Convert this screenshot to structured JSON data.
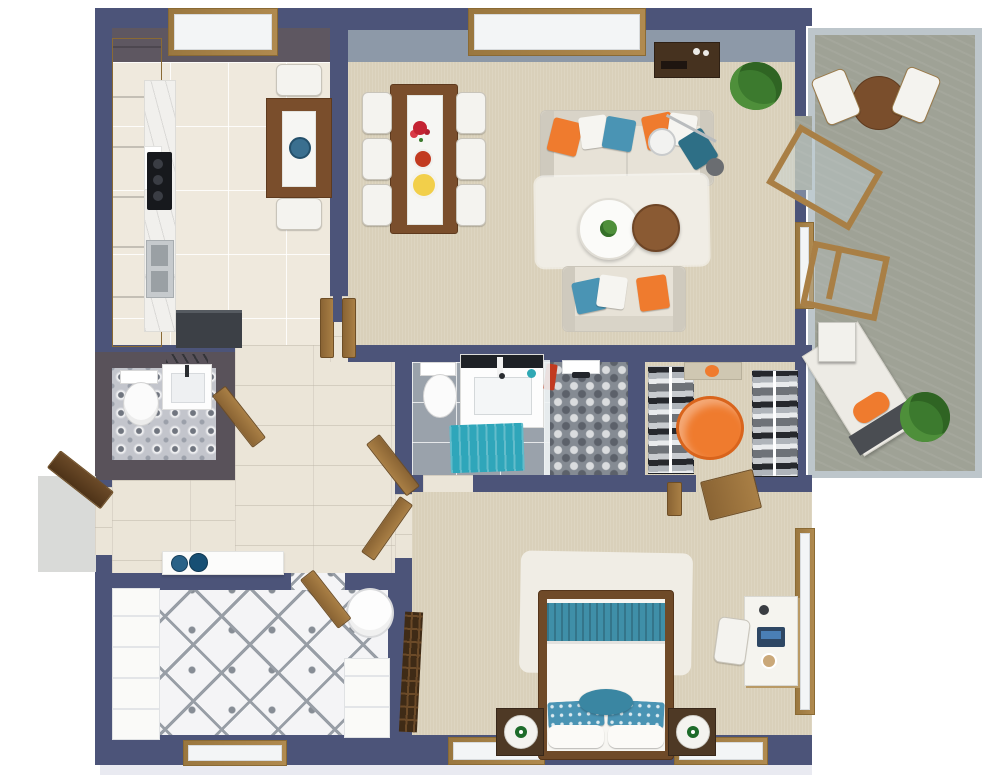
{
  "scene": {
    "type": "3d-floor-plan-render",
    "view": "top-down",
    "visible_text": "none"
  },
  "colors": {
    "wall_navy": "#4c5479",
    "wall_face_dark": "#5e5761",
    "wall_face_blue": "#8d99a8",
    "glass_rail": "#bdc6cb",
    "floor_kitchen": "#efe9dd",
    "floor_carpet": "#d9d0ba",
    "floor_hall": "#ebe5d8",
    "floor_bath": "#9aa2ab",
    "floor_shower": "#858b93",
    "floor_balcony": "#9fa296",
    "floor_wc": "#c3c5cc",
    "floor_laundry": "#f4f4f6",
    "wood": "#b08a4f",
    "wood_dark": "#7a4e2c",
    "wood_door": "#a97f45",
    "dark_console": "#46321f",
    "white_soft": "#fafaf8",
    "sofa": "#e7e2d7",
    "sofa_edge": "#cbc6ba",
    "orange": "#ef7b2e",
    "teal": "#3f8fa8",
    "teal_dark": "#2e6f86",
    "teal_mat": "#2fa6ba",
    "pillow_blue": "#4a94b4",
    "rug_white": "#f0ede5",
    "green": "#4e8f3a",
    "green_dark": "#3c7a2e",
    "steel": "#c6cacd",
    "appliance_dark": "#3c4046",
    "cooktop_black": "#17191d",
    "lamp_green": "#1d6b2a",
    "towel_red": "#c23a20",
    "plate_yellow": "#f2cf4a",
    "bowl_blue": "#2a6287",
    "shadow": "#e9eaf1"
  },
  "rooms": [
    {
      "name": "kitchen",
      "floor": "light-tile",
      "furniture": [
        "l-shaped-wood-cabinets",
        "marble-counter",
        "cooktop",
        "double-sink",
        "refrigerator",
        "breakfast-table",
        "two-white-chairs",
        "blue-plant-pot",
        "window"
      ]
    },
    {
      "name": "dining-area",
      "floor": "beige-carpet",
      "furniture": [
        "wood-dining-table",
        "white-runner",
        "red-flowers",
        "fruit-bowl",
        "yellow-plate",
        "six-white-chairs"
      ]
    },
    {
      "name": "living-room",
      "floor": "beige-carpet",
      "furniture": [
        "three-seat-sofa",
        "loveseat",
        "orange-blue-white-pillows",
        "arc-floor-lamp",
        "round-coffee-table",
        "round-wood-side-table",
        "white-area-rug",
        "media-console",
        "potted-plant",
        "open-double-doors",
        "large-window"
      ]
    },
    {
      "name": "balcony",
      "floor": "concrete",
      "furniture": [
        "glass-railing",
        "round-bistro-table",
        "two-folding-chairs",
        "wood-deck-chair",
        "open-glass-door",
        "sun-lounger",
        "orange-cushion",
        "white-side-table",
        "potted-plant"
      ]
    },
    {
      "name": "powder-room",
      "floor": "patterned-tile",
      "furniture": [
        "toilet",
        "vanity-sink",
        "mirror",
        "open-door"
      ]
    },
    {
      "name": "bathroom",
      "floor": "grey-tile",
      "furniture": [
        "toilet",
        "vanity-with-dark-top",
        "teal-bath-mat",
        "red-towel",
        "walk-in-shower",
        "hex-mosaic-floor",
        "glass-partition",
        "shower-head",
        "open-door"
      ]
    },
    {
      "name": "walk-in-closet",
      "floor": "beige-carpet",
      "furniture": [
        "clothes-rack-left",
        "clothes-rack-right",
        "orange-ottoman",
        "wall-mirror",
        "open-door"
      ]
    },
    {
      "name": "bedroom",
      "floor": "beige-carpet",
      "furniture": [
        "double-bed",
        "teal-pleated-runner",
        "blue-patterned-pillows",
        "white-pillows",
        "two-nightstands",
        "two-globe-lamps",
        "white-shag-rug",
        "desk",
        "desk-chair",
        "laptop",
        "folding-screen",
        "two-bottom-windows",
        "tall-side-window",
        "open-door"
      ]
    },
    {
      "name": "laundry-room",
      "floor": "patterned-cement-tile",
      "furniture": [
        "white-cabinet-run",
        "white-storage-unit",
        "round-hamper",
        "window",
        "open-door"
      ]
    },
    {
      "name": "hallway",
      "floor": "wood-look-tile",
      "furniture": [
        "white-console-table",
        "two-blue-bowls",
        "open-front-door",
        "entry-step"
      ]
    }
  ]
}
